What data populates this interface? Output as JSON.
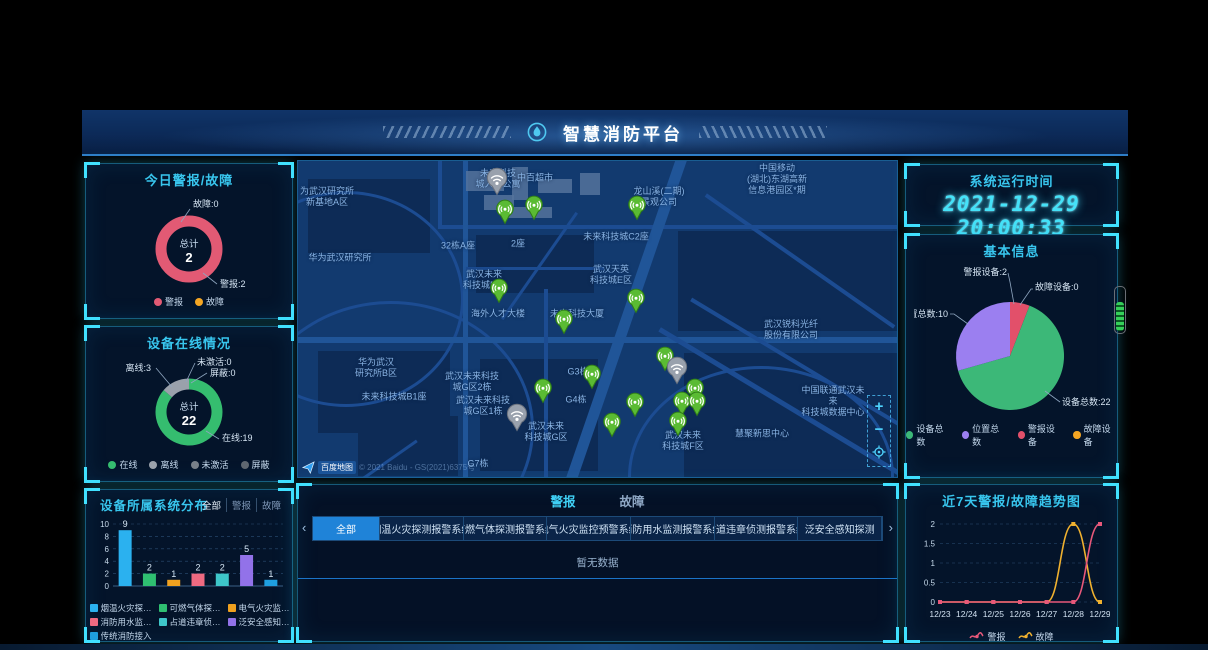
{
  "header": {
    "title": "智慧消防平台"
  },
  "panels": {
    "today": {
      "title": "今日警报/故障"
    },
    "online": {
      "title": "设备在线情况"
    },
    "distribution": {
      "title": "设备所属系统分布",
      "filters": [
        "全部",
        "警报",
        "故障"
      ],
      "active_filter": "全部"
    },
    "runtime": {
      "title": "系统运行时间",
      "datetime": "2021-12-29 20:00:33"
    },
    "basic": {
      "title": "基本信息"
    },
    "trend": {
      "title": "近7天警报/故障趋势图"
    },
    "alarm_list": {
      "tabs": [
        "警报",
        "故障"
      ],
      "active_tab": "警报",
      "filters": [
        "全部",
        "烟温火灾探测报警系统",
        "可燃气体探测报警系统",
        "电气火灾监控预警系统",
        "消防用水监测报警系统",
        "占道违章侦测报警系统",
        "泛安全感知探测"
      ],
      "active_filter": "全部",
      "left_arrow": "‹",
      "right_arrow": "›",
      "empty_text": "暂无数据"
    }
  },
  "map": {
    "attribution": {
      "logo_text": "百度地图",
      "copyright": "© 2021 Baidu - GS(2021)6375号"
    },
    "controls": {
      "zoom_in": "+",
      "zoom_out": "−"
    },
    "labels": [
      {
        "text": "未来科技\n城人才公寓",
        "x": 200,
        "y": 18
      },
      {
        "text": "中百超市",
        "x": 237,
        "y": 17
      },
      {
        "text": "为武汉研究所\n新基地A区",
        "x": 29,
        "y": 36
      },
      {
        "text": "龙山溪(二期)\n景观公司",
        "x": 361,
        "y": 36
      },
      {
        "text": "中国移动\n(湖北)东湖高新\n信息港园区*期",
        "x": 479,
        "y": 18
      },
      {
        "text": "32栋A座",
        "x": 160,
        "y": 85
      },
      {
        "text": "2座",
        "x": 220,
        "y": 83
      },
      {
        "text": "未来科技城C2座",
        "x": 318,
        "y": 76
      },
      {
        "text": "华为武汉研究所",
        "x": 42,
        "y": 97
      },
      {
        "text": "武汉未来\n科技城B区",
        "x": 186,
        "y": 119
      },
      {
        "text": "武汉天英\n科技城E区",
        "x": 313,
        "y": 114
      },
      {
        "text": "海外人才大楼",
        "x": 200,
        "y": 153
      },
      {
        "text": "未来科技大厦",
        "x": 279,
        "y": 153
      },
      {
        "text": "武汉锐科光纤\n股份有限公司",
        "x": 493,
        "y": 169
      },
      {
        "text": "华为武汉\n研究所B区",
        "x": 78,
        "y": 207
      },
      {
        "text": "未来科技城B1座",
        "x": 96,
        "y": 236
      },
      {
        "text": "武汉未来科技\n城G区2栋",
        "x": 174,
        "y": 221
      },
      {
        "text": "武汉未来科技\n城G区1栋",
        "x": 185,
        "y": 245
      },
      {
        "text": "G3栋",
        "x": 280,
        "y": 211
      },
      {
        "text": "G4栋",
        "x": 278,
        "y": 239
      },
      {
        "text": "武汉未来\n科技城G区",
        "x": 248,
        "y": 271
      },
      {
        "text": "G7栋",
        "x": 180,
        "y": 303
      },
      {
        "text": "中国联通武汉未来\n科技城数据中心",
        "x": 535,
        "y": 240
      },
      {
        "text": "慧聚新思中心",
        "x": 464,
        "y": 273
      },
      {
        "text": "武汉未来\n科技城F区",
        "x": 385,
        "y": 280
      }
    ],
    "markers": [
      {
        "x": 207,
        "y": 57,
        "type": "online"
      },
      {
        "x": 236,
        "y": 53,
        "type": "online"
      },
      {
        "x": 201,
        "y": 136,
        "type": "online"
      },
      {
        "x": 339,
        "y": 53,
        "type": "online"
      },
      {
        "x": 338,
        "y": 146,
        "type": "online"
      },
      {
        "x": 266,
        "y": 167,
        "type": "online"
      },
      {
        "x": 294,
        "y": 222,
        "type": "online"
      },
      {
        "x": 245,
        "y": 236,
        "type": "online"
      },
      {
        "x": 367,
        "y": 204,
        "type": "online"
      },
      {
        "x": 397,
        "y": 236,
        "type": "online"
      },
      {
        "x": 384,
        "y": 249,
        "type": "online"
      },
      {
        "x": 399,
        "y": 249,
        "type": "online"
      },
      {
        "x": 337,
        "y": 250,
        "type": "online"
      },
      {
        "x": 314,
        "y": 270,
        "type": "online"
      },
      {
        "x": 380,
        "y": 269,
        "type": "online"
      },
      {
        "x": 199,
        "y": 27,
        "type": "offline"
      },
      {
        "x": 219,
        "y": 263,
        "type": "offline"
      },
      {
        "x": 379,
        "y": 216,
        "type": "offline"
      }
    ]
  },
  "chart_data": [
    {
      "id": "today_alarm",
      "type": "donut",
      "title": "今日警报/故障",
      "center_label": "总计",
      "center_value": "2",
      "series": [
        {
          "name": "警报",
          "value": 2,
          "color": "#e25a74"
        },
        {
          "name": "故障",
          "value": 0,
          "color": "#f5a623"
        }
      ],
      "callouts": [
        "故障:0",
        "警报:2"
      ]
    },
    {
      "id": "device_online",
      "type": "donut",
      "title": "设备在线情况",
      "center_label": "总计",
      "center_value": "22",
      "series": [
        {
          "name": "在线",
          "value": 19,
          "color": "#35bd6f"
        },
        {
          "name": "离线",
          "value": 3,
          "color": "#9aa1ab"
        },
        {
          "name": "未激活",
          "value": 0,
          "color": "#788089"
        },
        {
          "name": "屏蔽",
          "value": 0,
          "color": "#5f6770"
        }
      ],
      "callouts": [
        "离线:3",
        "未激活:0",
        "屏蔽:0",
        "在线:19"
      ]
    },
    {
      "id": "system_distribution",
      "type": "bar",
      "title": "设备所属系统分布",
      "categories": [
        "烟温火灾探测报警系统",
        "可燃气体探测报警系统",
        "电气火灾监控预警系统",
        "消防用水监测报警系统",
        "占道违章侦测报警系统",
        "泛安全感知探测",
        "传统消防接入"
      ],
      "values": [
        9,
        2,
        1,
        2,
        2,
        5,
        1
      ],
      "colors": [
        "#2bb1ef",
        "#2fbf71",
        "#f0a11f",
        "#ef6a81",
        "#3ec6c9",
        "#9272e9",
        "#1f9fe0"
      ],
      "ylim": [
        0,
        10
      ],
      "yticks": [
        0,
        2,
        4,
        6,
        8,
        10
      ],
      "xlabel": "",
      "ylabel": ""
    },
    {
      "id": "basic_info",
      "type": "pie",
      "title": "基本信息",
      "series": [
        {
          "name": "设备总数",
          "value": 22,
          "color": "#3cb878"
        },
        {
          "name": "位置总数",
          "value": 10,
          "color": "#9b7ff0"
        },
        {
          "name": "警报设备",
          "value": 2,
          "color": "#e2506a"
        },
        {
          "name": "故障设备",
          "value": 0,
          "color": "#f5a623"
        }
      ],
      "callouts": [
        "警报设备:2",
        "故障设备:0",
        "位置总数:10",
        "设备总数:22"
      ]
    },
    {
      "id": "trend",
      "type": "line",
      "title": "近7天警报/故障趋势图",
      "x": [
        "12/23",
        "12/24",
        "12/25",
        "12/26",
        "12/27",
        "12/28",
        "12/29"
      ],
      "series": [
        {
          "name": "故障",
          "values": [
            0,
            0,
            0,
            0,
            0,
            2,
            0
          ],
          "color": "#f0b12f"
        },
        {
          "name": "警报",
          "values": [
            0,
            0,
            0,
            0,
            0,
            0,
            2
          ],
          "color": "#e8587a"
        }
      ],
      "ylim": [
        0,
        2
      ],
      "yticks": [
        0,
        0.5,
        1,
        1.5,
        2
      ],
      "legend_order": [
        "警报",
        "故障"
      ]
    }
  ]
}
